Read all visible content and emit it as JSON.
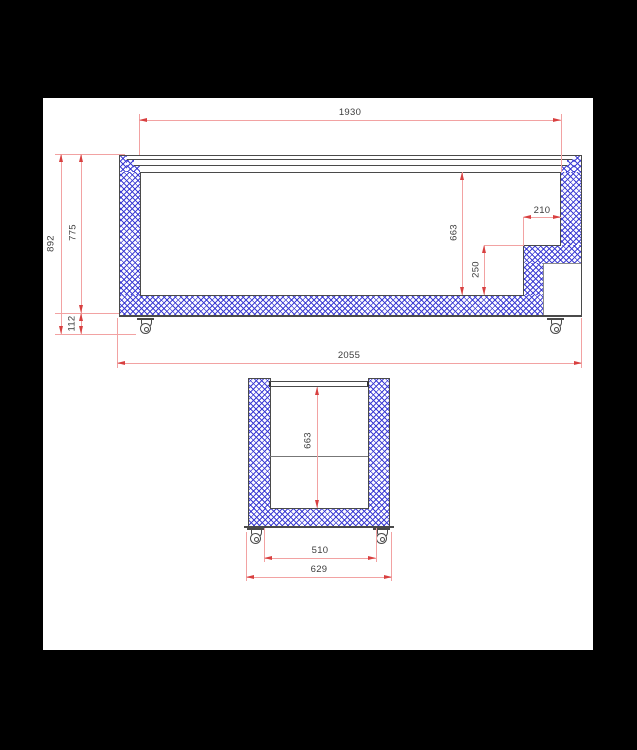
{
  "drawing": {
    "kind": "chest-freezer cross-section technical drawing",
    "colors": {
      "paper": "#ffffff",
      "background": "#000000",
      "outline": "#4a4a4a",
      "insulation_hatch": "#3c3cd8",
      "dimension_line": "#f2a2a2",
      "dimension_arrow": "#d84040",
      "dimension_text": "#3d3d3d"
    },
    "side_view": {
      "dims": {
        "lid_width": "1930",
        "overall_height": "892",
        "body_height": "775",
        "base_clearance": "112",
        "interior_depth": "663",
        "step_height": "250",
        "step_depth": "210",
        "overall_length": "2055"
      }
    },
    "front_view": {
      "dims": {
        "interior_depth": "663",
        "wheel_track": "510",
        "overall_width": "629"
      }
    }
  }
}
